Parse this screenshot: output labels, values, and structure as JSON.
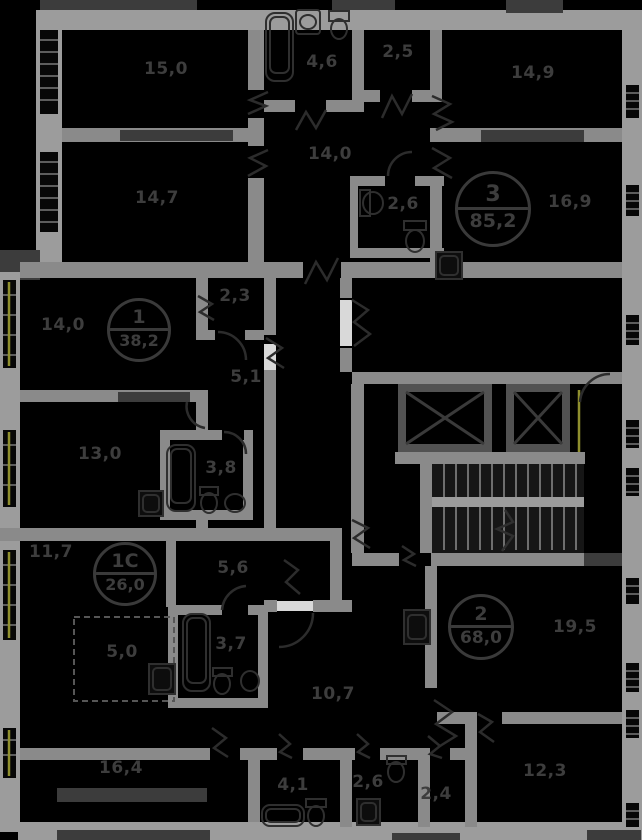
{
  "plan": {
    "title": "Floor plan",
    "apartments": [
      {
        "number": "3",
        "total_area": "85,2",
        "room_areas": [
          "15,0",
          "14,7",
          "4,6",
          "2,5",
          "14,9",
          "14,0",
          "2,6",
          "16,9"
        ]
      },
      {
        "number": "1",
        "total_area": "38,2",
        "room_areas": [
          "14,0",
          "2,3",
          "5,1",
          "13,0",
          "3,8"
        ]
      },
      {
        "number": "1С",
        "total_area": "26,0",
        "room_areas": [
          "11,7",
          "5,6",
          "5,0",
          "3,7"
        ]
      },
      {
        "number": "2",
        "total_area": "68,0",
        "room_areas": [
          "19,5",
          "10,7",
          "16,4",
          "4,1",
          "2,6",
          "2,4",
          "12,3"
        ]
      }
    ],
    "fixtures": [
      "bathtub",
      "sink",
      "toilet",
      "washing-machine",
      "elevator-shaft",
      "staircase",
      "door-swing"
    ]
  },
  "colors": {
    "background": "#000000",
    "wall_exterior": "#9c9c9c",
    "wall_interior": "#8a8a8a",
    "wall_dark_inset": "#3c3c3c",
    "label_text": "#3d3d3d",
    "window_accent": "#8f8f2e"
  }
}
